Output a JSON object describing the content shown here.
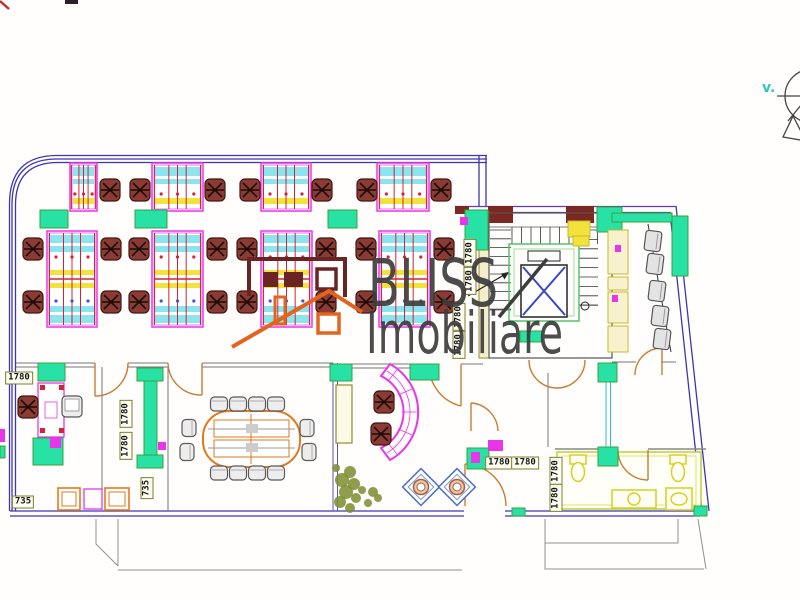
{
  "watermark": {
    "line1": "BLISS",
    "line2": "Imobiliare",
    "color": "#3d3d3d"
  },
  "compass": {
    "label": "v.",
    "label_color": "#35c4bd"
  },
  "dimension_labels": [
    {
      "text": "1780",
      "cx": 19,
      "cy": 378,
      "rot": 0
    },
    {
      "text": "735",
      "cx": 23,
      "cy": 502,
      "rot": 0
    },
    {
      "text": "735",
      "cx": 147,
      "cy": 488,
      "rot": -90
    },
    {
      "text": "1780",
      "cx": 126,
      "cy": 414,
      "rot": -90
    },
    {
      "text": "1780",
      "cx": 126,
      "cy": 446,
      "rot": -90
    },
    {
      "text": "1780",
      "cx": 499,
      "cy": 463,
      "rot": 0
    },
    {
      "text": "1780",
      "cx": 525,
      "cy": 463,
      "rot": 0
    },
    {
      "text": "1780",
      "cx": 556,
      "cy": 471,
      "rot": -90
    },
    {
      "text": "1780",
      "cx": 556,
      "cy": 498,
      "rot": -90
    },
    {
      "text": "1780",
      "cx": 470,
      "cy": 253,
      "rot": -90
    },
    {
      "text": "1780",
      "cx": 470,
      "cy": 281,
      "rot": -90
    },
    {
      "text": "1780",
      "cx": 459,
      "cy": 317,
      "rot": -90
    },
    {
      "text": "1780",
      "cx": 459,
      "cy": 345,
      "rot": -90
    }
  ],
  "colors": {
    "wall": "#3c36b4",
    "wall_purple": "#6038b8",
    "maroon_wall": "#7b2822",
    "magenta": "#e935e9",
    "cyan": "#8ce4ee",
    "yellow": "#f2e23c",
    "red_line": "#d22433",
    "teal": "#27e2a4",
    "teal_border": "#3aa13a",
    "chair_fill": "#8c3a34",
    "chair_stroke": "#401812",
    "cream": "#f7f2cd",
    "cream_border": "#c8b72a",
    "orange": "#e2791e",
    "gray_wall": "#777777",
    "meeting_chair": "#ededed",
    "terrace": "#909090",
    "fixture": "#d8cf1f"
  },
  "furniture": {
    "desk_clusters_single": [
      {
        "x": 70,
        "y": 163,
        "w": 27,
        "h": 48
      },
      {
        "x": 152,
        "y": 163,
        "w": 51,
        "h": 48
      },
      {
        "x": 261,
        "y": 163,
        "w": 50,
        "h": 48
      },
      {
        "x": 377,
        "y": 163,
        "w": 52,
        "h": 48
      }
    ],
    "desk_clusters_double": [
      {
        "x": 47,
        "y": 231,
        "w": 50,
        "h": 96
      },
      {
        "x": 152,
        "y": 231,
        "w": 51,
        "h": 96
      },
      {
        "x": 261,
        "y": 231,
        "w": 51,
        "h": 96
      },
      {
        "x": 379,
        "y": 231,
        "w": 51,
        "h": 96
      }
    ],
    "task_chairs": [
      [
        110,
        190
      ],
      [
        140,
        190
      ],
      [
        215,
        190
      ],
      [
        250,
        190
      ],
      [
        322,
        190
      ],
      [
        367,
        190
      ],
      [
        441,
        190
      ],
      [
        33,
        249
      ],
      [
        33,
        302
      ],
      [
        111,
        249
      ],
      [
        111,
        302
      ],
      [
        139,
        249
      ],
      [
        139,
        302
      ],
      [
        217,
        249
      ],
      [
        217,
        302
      ],
      [
        247,
        249
      ],
      [
        247,
        302
      ],
      [
        326,
        249
      ],
      [
        326,
        302
      ],
      [
        366,
        249
      ],
      [
        366,
        302
      ],
      [
        444,
        249
      ],
      [
        444,
        302
      ],
      [
        28,
        407
      ],
      [
        384,
        402
      ],
      [
        381,
        434
      ]
    ],
    "meeting_chairs": [
      [
        219,
        404,
        0
      ],
      [
        238,
        404,
        0
      ],
      [
        257,
        404,
        0
      ],
      [
        276,
        404,
        0
      ],
      [
        219,
        473,
        0
      ],
      [
        238,
        473,
        0
      ],
      [
        257,
        473,
        0
      ],
      [
        276,
        473,
        0
      ],
      [
        189,
        428,
        90
      ],
      [
        187,
        452,
        90
      ],
      [
        307,
        428,
        90
      ],
      [
        309,
        452,
        90
      ]
    ],
    "waiting_chairs": [
      [
        653,
        241
      ],
      [
        655,
        264
      ],
      [
        657,
        291
      ],
      [
        660,
        316
      ],
      [
        662,
        339
      ]
    ],
    "columns": [
      [
        40,
        210,
        28,
        18
      ],
      [
        135,
        210,
        32,
        18
      ],
      [
        328,
        210,
        29,
        18
      ],
      [
        38,
        363,
        27,
        18
      ],
      [
        330,
        364,
        22,
        17
      ],
      [
        410,
        364,
        29,
        16
      ],
      [
        467,
        448,
        22,
        21
      ],
      [
        598,
        363,
        19,
        19
      ],
      [
        598,
        447,
        20,
        19
      ],
      [
        465,
        210,
        23,
        40
      ],
      [
        597,
        207,
        25,
        25
      ],
      [
        33,
        438,
        30,
        27
      ],
      [
        512,
        508,
        13,
        8
      ],
      [
        694,
        506,
        13,
        10
      ],
      [
        612,
        213,
        60,
        9
      ],
      [
        672,
        216,
        16,
        60
      ],
      [
        137,
        368,
        26,
        13
      ],
      [
        144,
        381,
        13,
        74
      ],
      [
        137,
        455,
        26,
        13
      ],
      [
        0,
        446,
        5,
        12
      ],
      [
        520,
        331,
        22,
        11
      ]
    ],
    "kitchen_units": [
      [
        608,
        230,
        20,
        44
      ],
      [
        608,
        277,
        20,
        13
      ],
      [
        608,
        292,
        20,
        31
      ],
      [
        608,
        326,
        20,
        26
      ]
    ],
    "yellow_units": [
      [
        568,
        221,
        22,
        16
      ],
      [
        573,
        236,
        16,
        10
      ]
    ],
    "cabinets": [
      [
        336,
        385,
        16,
        58
      ]
    ],
    "magenta_marks": [
      [
        0,
        429,
        5,
        13
      ],
      [
        50,
        437,
        11,
        11
      ],
      [
        471,
        452,
        9,
        11
      ],
      [
        488,
        440,
        15,
        11
      ],
      [
        615,
        245,
        6,
        7
      ],
      [
        612,
        295,
        6,
        7
      ],
      [
        158,
        442,
        8,
        8
      ],
      [
        460,
        217,
        8,
        8
      ]
    ],
    "stools": [
      [
        421,
        487
      ],
      [
        457,
        487
      ]
    ],
    "plant_blobs": [
      [
        350,
        472,
        6
      ],
      [
        342,
        480,
        7
      ],
      [
        354,
        484,
        6
      ],
      [
        346,
        492,
        7
      ],
      [
        356,
        498,
        5
      ],
      [
        340,
        502,
        6
      ],
      [
        350,
        508,
        5
      ],
      [
        362,
        490,
        4
      ],
      [
        373,
        492,
        5
      ],
      [
        378,
        498,
        4
      ],
      [
        368,
        503,
        4
      ],
      [
        336,
        468,
        4
      ]
    ]
  }
}
